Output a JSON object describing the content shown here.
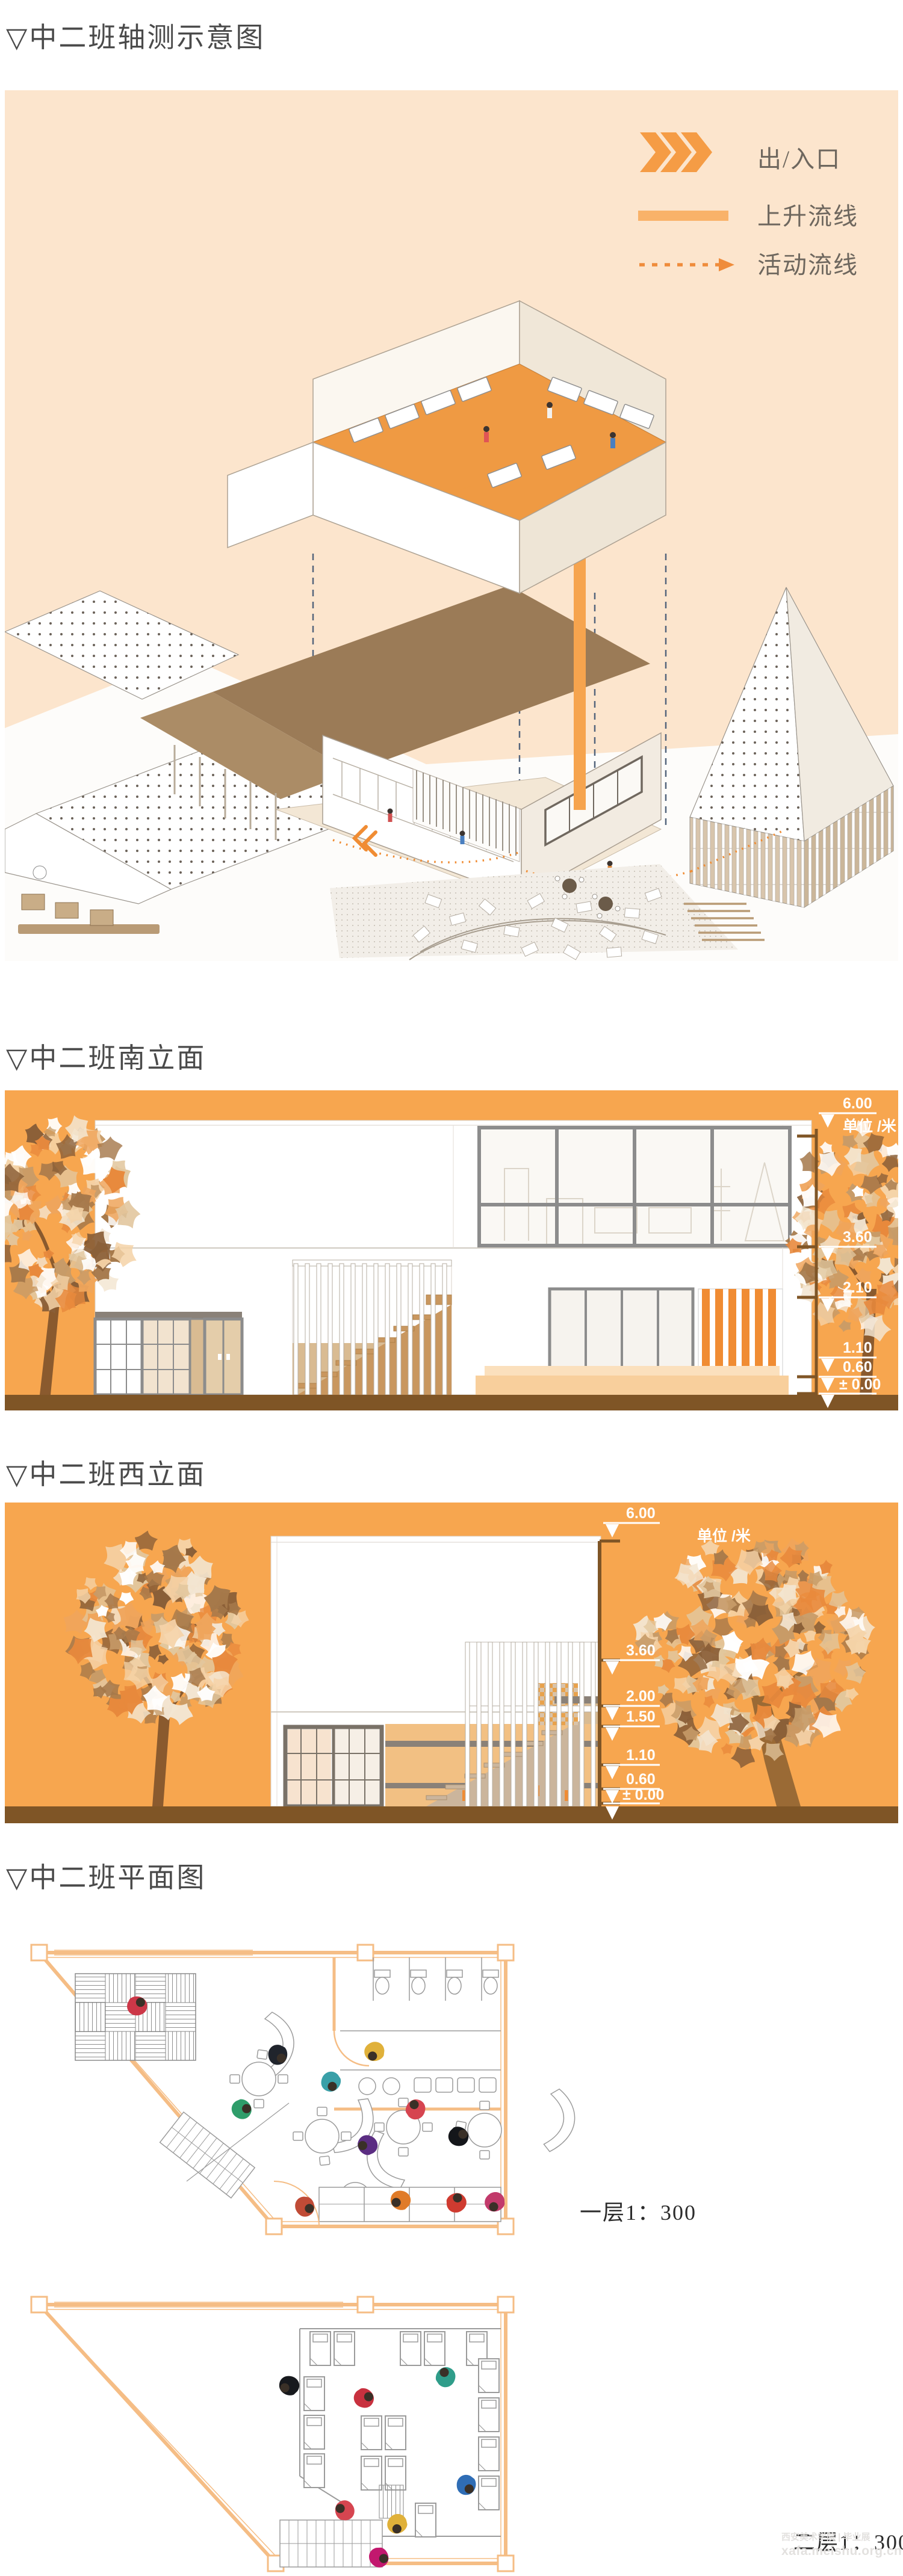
{
  "sections": {
    "axon": {
      "title": "▽中二班轴测示意图"
    },
    "south": {
      "title": "▽中二班南立面"
    },
    "west": {
      "title": "▽中二班西立面"
    },
    "plan": {
      "title": "▽中二班平面图"
    }
  },
  "legend": {
    "entrance": "出/入口",
    "rising": "上升流线",
    "activity": "活动流线"
  },
  "south": {
    "unit": "单位 /米",
    "levels": [
      "6.00",
      "3.60",
      "2.10",
      "1.10",
      "0.60",
      "± 0.00"
    ]
  },
  "west": {
    "unit": "单位 /米",
    "levels": [
      "6.00",
      "3.60",
      "2.00",
      "1.50",
      "1.10",
      "0.60",
      "± 0.00"
    ]
  },
  "plans": {
    "first": "一层1：300",
    "second": "二层1：300"
  },
  "watermark": {
    "line1": "西安美术学院 | 毕业展",
    "line2": "xafa.meishu.org.cn"
  },
  "colors": {
    "panel_peach": "#fce5cd",
    "panel_orange": "#f7a64f",
    "accent_orange": "#f08c33",
    "legend_bar": "#f9b269",
    "ground_brown": "#7f5526",
    "roof_brown": "#9b7b57",
    "plan_wall": "#f5bd85"
  }
}
